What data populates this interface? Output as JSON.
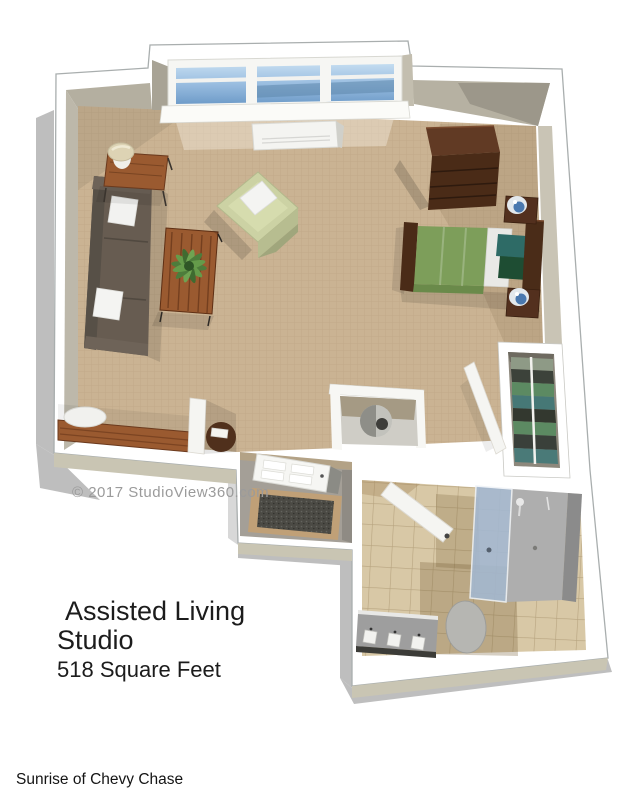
{
  "watermark": {
    "text": "© 2017 StudioView360.com",
    "color": "#9b9b9b"
  },
  "caption": {
    "line1": "Assisted Living",
    "line2": "Studio",
    "subtitle": "518 Square Feet",
    "color": "#1c1c1c"
  },
  "footer": {
    "text": "Sunrise of Chevy Chase",
    "color": "#141414"
  },
  "floorplan": {
    "view": "3d-overhead-floor-plan",
    "rooms": [
      {
        "name": "living-sleeping-area",
        "floor": "carpet"
      },
      {
        "name": "entry-vestibule",
        "floor": "vinyl"
      },
      {
        "name": "bathroom",
        "floor": "tile"
      },
      {
        "name": "closet",
        "floor": "shelves"
      }
    ],
    "furniture": [
      "window-bay",
      "radiator",
      "sofa",
      "throw-pillows",
      "side-table",
      "table-lamp",
      "coffee-table",
      "potted-plant",
      "armchair",
      "bed",
      "nightstand",
      "table-lamp-blue",
      "dresser",
      "desk",
      "desk-lamp",
      "round-table",
      "telephone",
      "entry-door",
      "door-mat",
      "closet-shelves",
      "closet-rod",
      "closet-door",
      "bathroom-door",
      "shower",
      "shower-glass",
      "toilet",
      "vanity-sink"
    ],
    "colors": {
      "carpet": "#cab393",
      "wall_white": "#ffffff",
      "wall_inner": "#b4afa0",
      "wall_outer_face": "#c9c5b3",
      "drop_shadow": "#a9a9a9",
      "window_glass": "#89add4",
      "sofa": "#675c51",
      "armchair": "#ccd2a4",
      "wood_dark": "#4a2b17",
      "wood_medium": "#9a5a30",
      "bed_blanket": "#7d9e5a",
      "bed_sheet": "#e9e9e6",
      "pillow_teal": "#2e6b66",
      "pillow_green": "#1e4d33",
      "tile": "#d8c8a6",
      "shower_glass": "#a3b8d2",
      "fixture_gray": "#aeaeae",
      "mat": "#4b4a44",
      "mat_border": "#c0a077"
    }
  }
}
